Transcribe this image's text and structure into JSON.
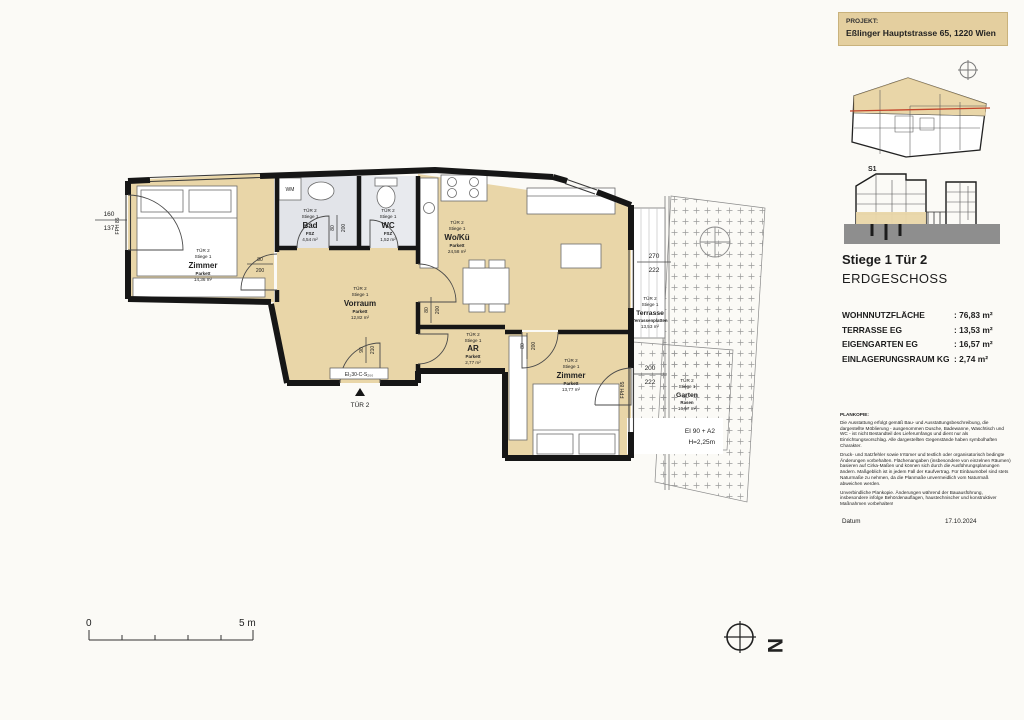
{
  "project": {
    "label": "PROJEKT:",
    "address": "Eßlinger Hauptstrasse 65, 1220 Wien"
  },
  "unit": {
    "title": "Stiege 1 Tür 2",
    "floor": "ERDGESCHOSS"
  },
  "section_label": "S1",
  "areas": {
    "rows": [
      {
        "label": "WOHNNUTZFLÄCHE",
        "value": ": 76,83 m²"
      },
      {
        "label": "TERRASSE  EG",
        "value": ": 13,53 m²"
      },
      {
        "label": "EIGENGARTEN  EG",
        "value": ": 16,57 m²"
      },
      {
        "label": "EINLAGERUNGSRAUM KG",
        "value": ": 2,74 m²"
      }
    ]
  },
  "rooms": [
    {
      "tuer": "TÜR 2",
      "stiege": "Stiege 1",
      "name": "Zimmer",
      "floor": "Parkett",
      "area": "14,36 m²"
    },
    {
      "tuer": "TÜR 2",
      "stiege": "Stiege 1",
      "name": "Bad",
      "floor": "FSZ",
      "area": "4,54 m²"
    },
    {
      "tuer": "TÜR 2",
      "stiege": "Stiege 1",
      "name": "WC",
      "floor": "FSZ",
      "area": "1,52 m²"
    },
    {
      "tuer": "TÜR 2",
      "stiege": "Stiege 1",
      "name": "Wo/Kü",
      "floor": "Parkett",
      "area": "24,58 m²"
    },
    {
      "tuer": "TÜR 2",
      "stiege": "Stiege 1",
      "name": "Vorraum",
      "floor": "Parkett",
      "area": "12,82 m²"
    },
    {
      "tuer": "TÜR 2",
      "stiege": "Stiege 1",
      "name": "AR",
      "floor": "Parkett",
      "area": "2,77 m²"
    },
    {
      "tuer": "TÜR 2",
      "stiege": "Stiege 1",
      "name": "Zimmer",
      "floor": "Parkett",
      "area": "13,77 m²"
    },
    {
      "tuer": "TÜR 2",
      "stiege": "Stiege 1",
      "name": "Terrasse",
      "floor": "Terrassenplatten",
      "area": "13,53 m²"
    },
    {
      "tuer": "TÜR 2",
      "stiege": "Stiege 1",
      "name": "Garten",
      "floor": "Rasen",
      "area": "16,57 m²"
    }
  ],
  "annotations": {
    "entry_door": "TÜR 2",
    "fire_door": "EI₂30-C-S₂₀₀",
    "wall_fire_1": "EI 90 + A2",
    "wall_fire_2": "H=2,25m",
    "wm": "WM",
    "fph_left": "FPH 85",
    "fph_right": "FPH 85",
    "north": "N"
  },
  "dimensions": {
    "left_top": "160",
    "left_bottom": "137",
    "win1_top": "270",
    "win1_bottom": "222",
    "win2_top": "200",
    "win2_bottom": "222",
    "d1_top": "80",
    "d1_bottom": "200",
    "d2_top": "80",
    "d2_bottom": "200",
    "d3_top": "80",
    "d3_bottom": "200",
    "d4_top": "90",
    "d4_bottom": "210",
    "d5_top": "80",
    "d5_bottom": "200"
  },
  "scalebar": {
    "zero": "0",
    "five": "5 m"
  },
  "disclaimer": {
    "title": "PLANKOPIE:",
    "p1": "Die Ausstattung erfolgt gemäß Bau- und Ausstattungsbeschreibung, die dargestellte Möblierung - ausgenommen Dusche, Badewanne, Waschtisch und WC - ist nicht Bestandteil des Lieferumfangs und dient nur als Einrichtungsvorschlag. Alle dargestellten Gegenstände haben symbolhaften Charakter.",
    "p2": "Druck- und Satzfehler sowie Irrtümer und textlich oder organisatorisch bedingte Änderungen vorbehalten. Flächenangaben (insbesondere von einzelnen Räumen) basieren auf Cirka-Maßen und können sich durch die Ausführungsplanungen ändern. Maßgeblich ist in jedem Fall der Kaufvertrag. Für Einbaumöbel sind stets Naturmaße zu nehmen, da die Planmaße unvermeidlich vom Naturmaß abweichen werden.",
    "p3": "Unverbindliche Plankopie. Änderungen während der Bauausführung, insbesondere infolge Behördenauflagen, haustechnischer und konstruktiver Maßnahmen vorbehalten!"
  },
  "footer": {
    "datum_label": "Datum",
    "date": "17.10.2024"
  },
  "colors": {
    "room_fill": "#e9d6a8",
    "wet_room_fill": "#e2e4e9",
    "wall": "#161616",
    "accent_red": "#c2452a",
    "section_ground": "#8e8e8e",
    "header_bg": "#e4cf9f"
  }
}
